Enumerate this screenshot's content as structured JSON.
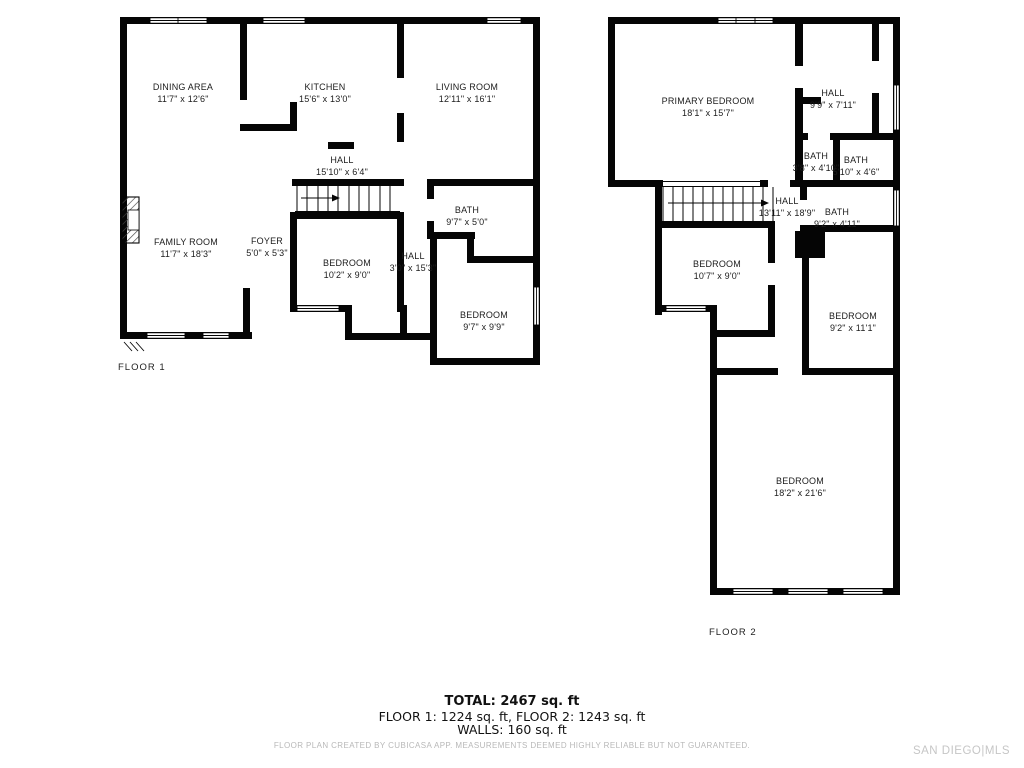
{
  "floor1": {
    "label": "FLOOR 1",
    "rooms": [
      {
        "name": "DINING AREA",
        "dims": "11'7\" x 12'6\""
      },
      {
        "name": "KITCHEN",
        "dims": "15'6\" x 13'0\""
      },
      {
        "name": "LIVING ROOM",
        "dims": "12'11\" x 16'1\""
      },
      {
        "name": "HALL",
        "dims": "15'10\" x 6'4\""
      },
      {
        "name": "FAMILY ROOM",
        "dims": "11'7\" x 18'3\""
      },
      {
        "name": "FOYER",
        "dims": "5'0\" x 5'3\""
      },
      {
        "name": "BEDROOM",
        "dims": "10'2\" x 9'0\""
      },
      {
        "name": "HALL",
        "dims": "3'0\" x 15'3\""
      },
      {
        "name": "BATH",
        "dims": "9'7\" x 5'0\""
      },
      {
        "name": "BEDROOM",
        "dims": "9'7\" x 9'9\""
      }
    ]
  },
  "floor2": {
    "label": "FLOOR 2",
    "rooms": [
      {
        "name": "PRIMARY BEDROOM",
        "dims": "18'1\" x 15'7\""
      },
      {
        "name": "HALL",
        "dims": "9'9\" x 7'11\""
      },
      {
        "name": "BATH",
        "dims": "3'8\" x 4'10\""
      },
      {
        "name": "BATH",
        "dims": "5'10\" x 4'6\""
      },
      {
        "name": "HALL",
        "dims": "13'11\" x 18'9\""
      },
      {
        "name": "BATH",
        "dims": "9'2\" x 4'11\""
      },
      {
        "name": "BEDROOM",
        "dims": "10'7\" x 9'0\""
      },
      {
        "name": "BEDROOM",
        "dims": "9'2\" x 11'1\""
      },
      {
        "name": "BEDROOM",
        "dims": "18'2\" x 21'6\""
      }
    ]
  },
  "summary": {
    "total": "TOTAL: 2467 sq. ft",
    "floors": "FLOOR 1: 1224 sq. ft, FLOOR 2: 1243 sq. ft",
    "walls": "WALLS: 160 sq. ft",
    "disclaimer": "FLOOR PLAN CREATED BY CUBICASA APP. MEASUREMENTS DEEMED HIGHLY RELIABLE BUT NOT GUARANTEED."
  },
  "watermark": {
    "text": "SAN DIEGO|MLS",
    "color": "#c6c6c6"
  },
  "colors": {
    "wall": "#050505",
    "background": "#ffffff"
  }
}
